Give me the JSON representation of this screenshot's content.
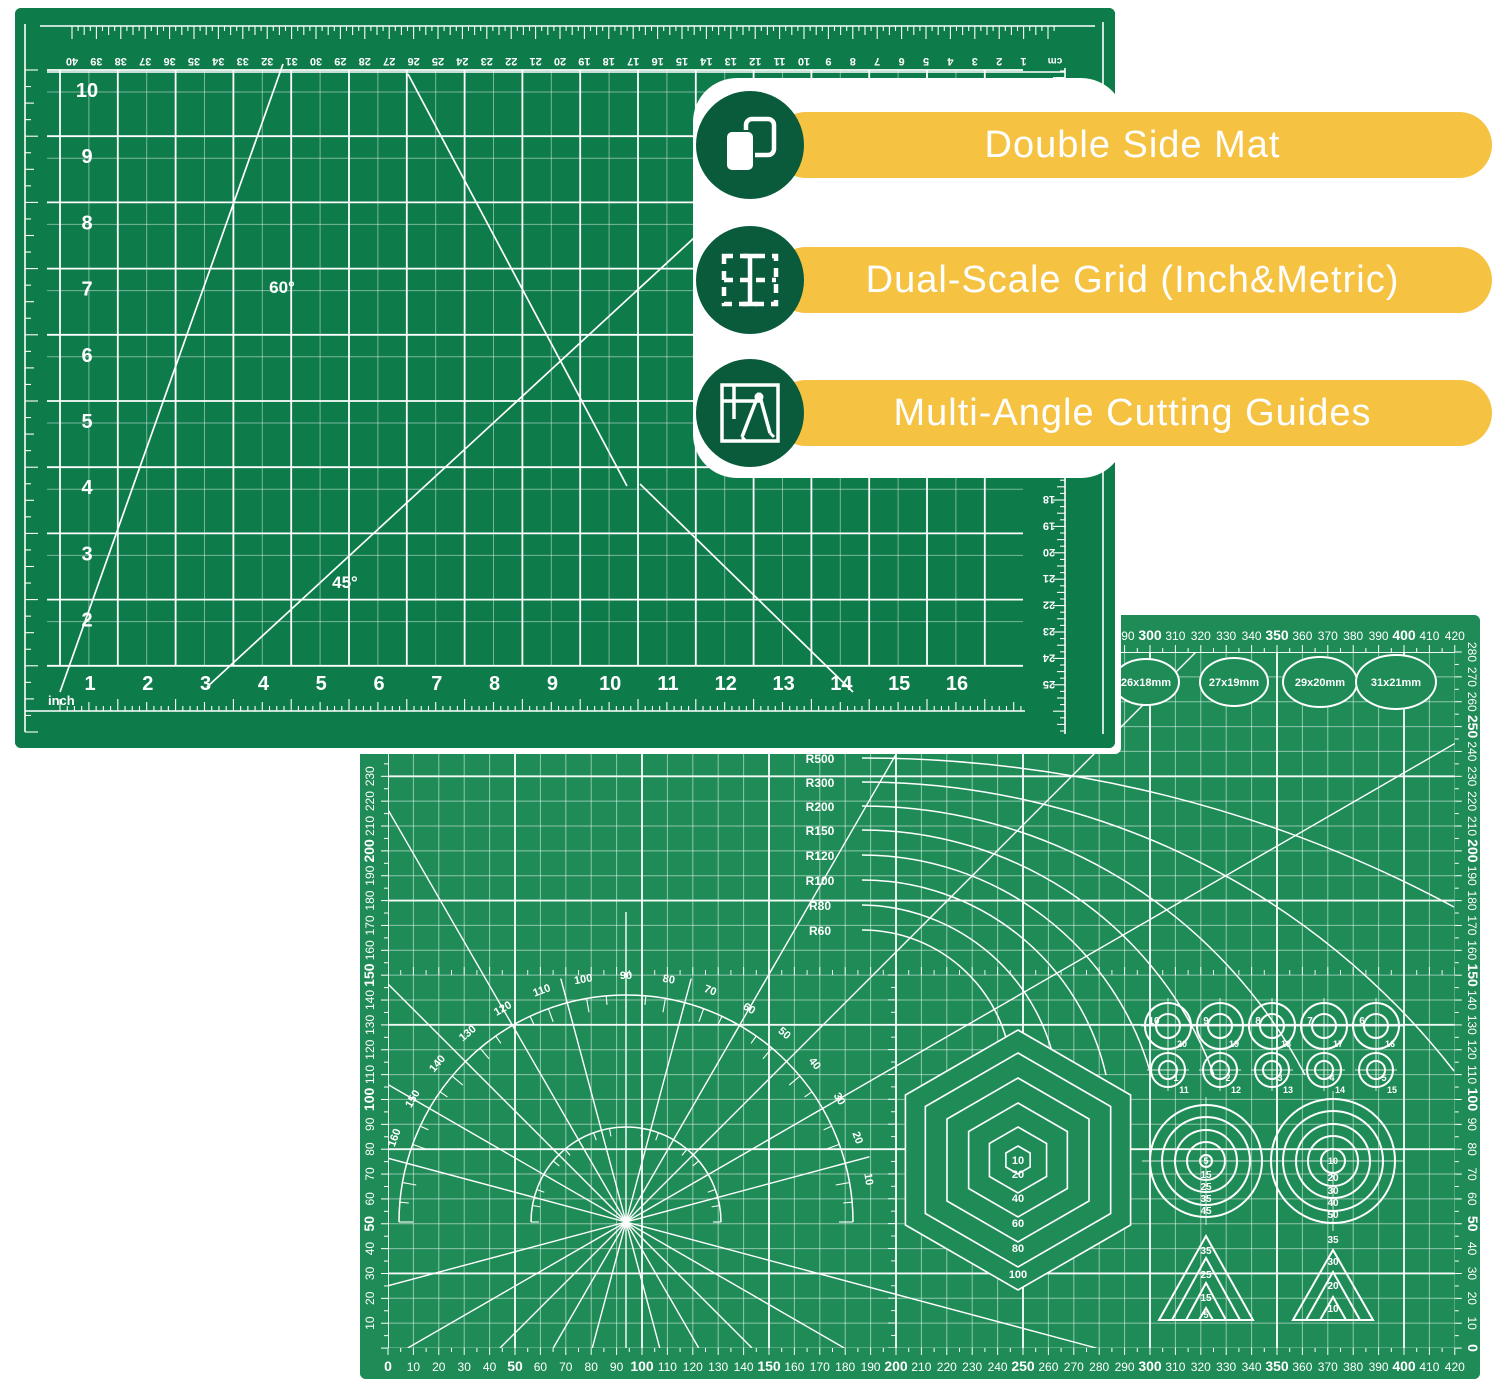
{
  "colors": {
    "mat1_green": "#0E7B4A",
    "mat2_green": "#1F8C57",
    "line_white": "#FFFFFF",
    "banner_yellow": "#F5C242",
    "icon_circle_green": "#0A5B3B",
    "card_white": "#FFFFFF"
  },
  "callouts": [
    {
      "icon": "copy-icon",
      "label": "Double Side Mat"
    },
    {
      "icon": "grid-icon",
      "label": "Dual-Scale Grid (Inch&Metric)"
    },
    {
      "icon": "compass-icon",
      "label": "Multi-Angle Cutting Guides"
    }
  ],
  "mat_inch": {
    "unit_label": "inch",
    "cm_label": "cm",
    "top_cm_numbers": [
      40,
      39,
      38,
      37,
      36,
      35,
      34,
      33,
      32,
      31,
      30,
      29,
      28,
      27,
      26,
      25,
      24,
      23,
      22,
      21,
      20,
      19,
      18,
      17,
      16,
      15,
      14,
      13,
      12,
      11,
      10,
      9,
      8,
      7,
      6,
      5,
      4,
      3,
      2,
      1
    ],
    "left_row_numbers": [
      10,
      9,
      8,
      7,
      6,
      5,
      4,
      3,
      2
    ],
    "bottom_col_numbers": [
      1,
      2,
      3,
      4,
      5,
      6,
      7,
      8,
      9,
      10,
      11,
      12,
      13,
      14,
      15,
      16
    ],
    "right_cm_numbers": [
      18,
      19,
      20,
      21,
      22,
      23,
      24,
      25
    ],
    "angle_labels": [
      "60°",
      "45°"
    ]
  },
  "mat_metric": {
    "top_numbers": [
      290,
      300,
      310,
      320,
      330,
      340,
      350,
      360,
      370,
      380,
      390,
      400,
      410,
      420
    ],
    "bottom_numbers": [
      0,
      10,
      20,
      30,
      40,
      50,
      60,
      70,
      80,
      90,
      100,
      110,
      120,
      130,
      140,
      150,
      160,
      170,
      180,
      190,
      200,
      210,
      220,
      230,
      240,
      250,
      260,
      270,
      280,
      290,
      300,
      310,
      320,
      330,
      340,
      350,
      360,
      370,
      380,
      390,
      400,
      410,
      420
    ],
    "left_numbers": [
      230,
      220,
      210,
      200,
      190,
      180,
      170,
      160,
      150,
      140,
      130,
      120,
      110,
      100,
      90,
      80,
      70,
      60,
      50,
      40,
      30,
      20,
      10
    ],
    "right_numbers": [
      280,
      270,
      260,
      250,
      240,
      230,
      220,
      210,
      200,
      190,
      180,
      170,
      160,
      150,
      140,
      130,
      120,
      110,
      100,
      90,
      80,
      70,
      60,
      50,
      40,
      30,
      20,
      10,
      0
    ],
    "radius_labels": [
      "R500",
      "R300",
      "R200",
      "R150",
      "R120",
      "R100",
      "R80",
      "R60"
    ],
    "degree_labels": [
      180,
      170,
      160,
      150,
      140,
      130,
      120,
      110,
      100,
      90,
      80,
      70,
      60,
      50,
      40,
      30,
      20,
      10
    ],
    "ellipse_labels": [
      "26x18mm",
      "27x19mm",
      "29x20mm",
      "31x21mm"
    ],
    "hexagon_labels": [
      "10",
      "20",
      "40",
      "60",
      "80",
      "100"
    ],
    "circle_row_a_labels": [
      "10",
      "9",
      "8",
      "7",
      "6"
    ],
    "circle_row_a_sublabels": [
      "20",
      "19",
      "18",
      "17",
      "16"
    ],
    "circle_row_b_labels": [
      "1",
      "2",
      "3",
      "4",
      "5"
    ],
    "circle_row_b_sublabels": [
      "11",
      "12",
      "13",
      "14",
      "15"
    ],
    "target_left_labels": [
      "5",
      "15",
      "25",
      "35",
      "45"
    ],
    "target_right_labels": [
      "10",
      "20",
      "30",
      "40",
      "50"
    ],
    "triangle_left_labels": [
      "35",
      "25",
      "15",
      "5"
    ],
    "triangle_right_labels": [
      "35",
      "30",
      "20",
      "10"
    ]
  }
}
